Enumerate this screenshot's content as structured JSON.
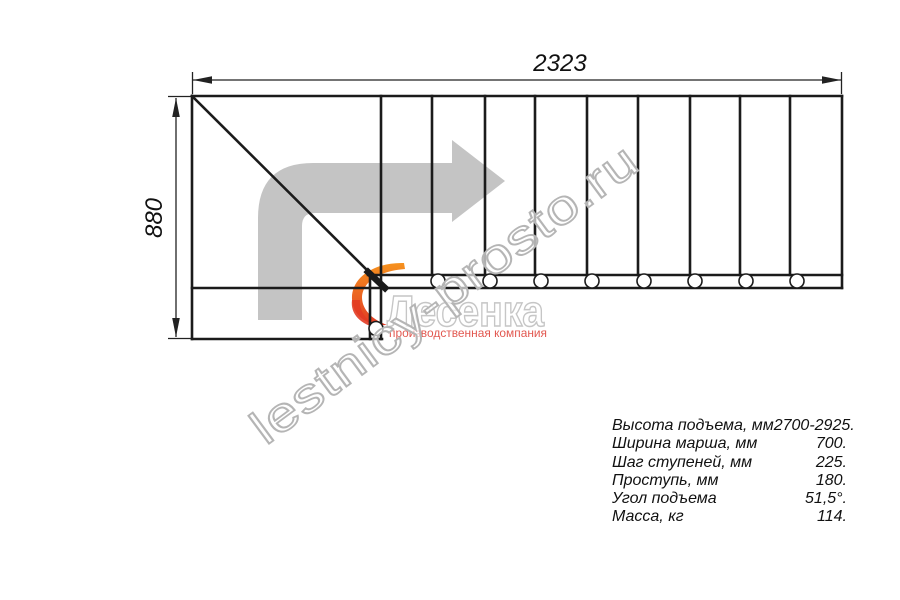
{
  "drawing": {
    "dim_width": "2323",
    "dim_height": "880"
  },
  "watermark": {
    "text": "lestnicy-prosto.ru"
  },
  "logo": {
    "name": "Лесенка",
    "tagline": "производственная компания"
  },
  "specs": {
    "rows": [
      {
        "label": "Высота подъема, мм",
        "value": "2700-2925."
      },
      {
        "label": "Ширина марша, мм",
        "value": "700."
      },
      {
        "label": "Шаг ступеней, мм",
        "value": "225."
      },
      {
        "label": "Проступь, мм",
        "value": "180."
      },
      {
        "label": "Угол подъема",
        "value": "51,5°."
      },
      {
        "label": "Масса, кг",
        "value": "114."
      }
    ]
  },
  "colors": {
    "line": "#1b1b1b",
    "arrow_gray": "#c4c4c4",
    "watermark_stroke": "#b5b5b5",
    "logo_stroke": "#c6c6c6",
    "flame_orange": "#f6921e",
    "flame_red": "#e23b24",
    "tagline_red": "#e25850"
  }
}
